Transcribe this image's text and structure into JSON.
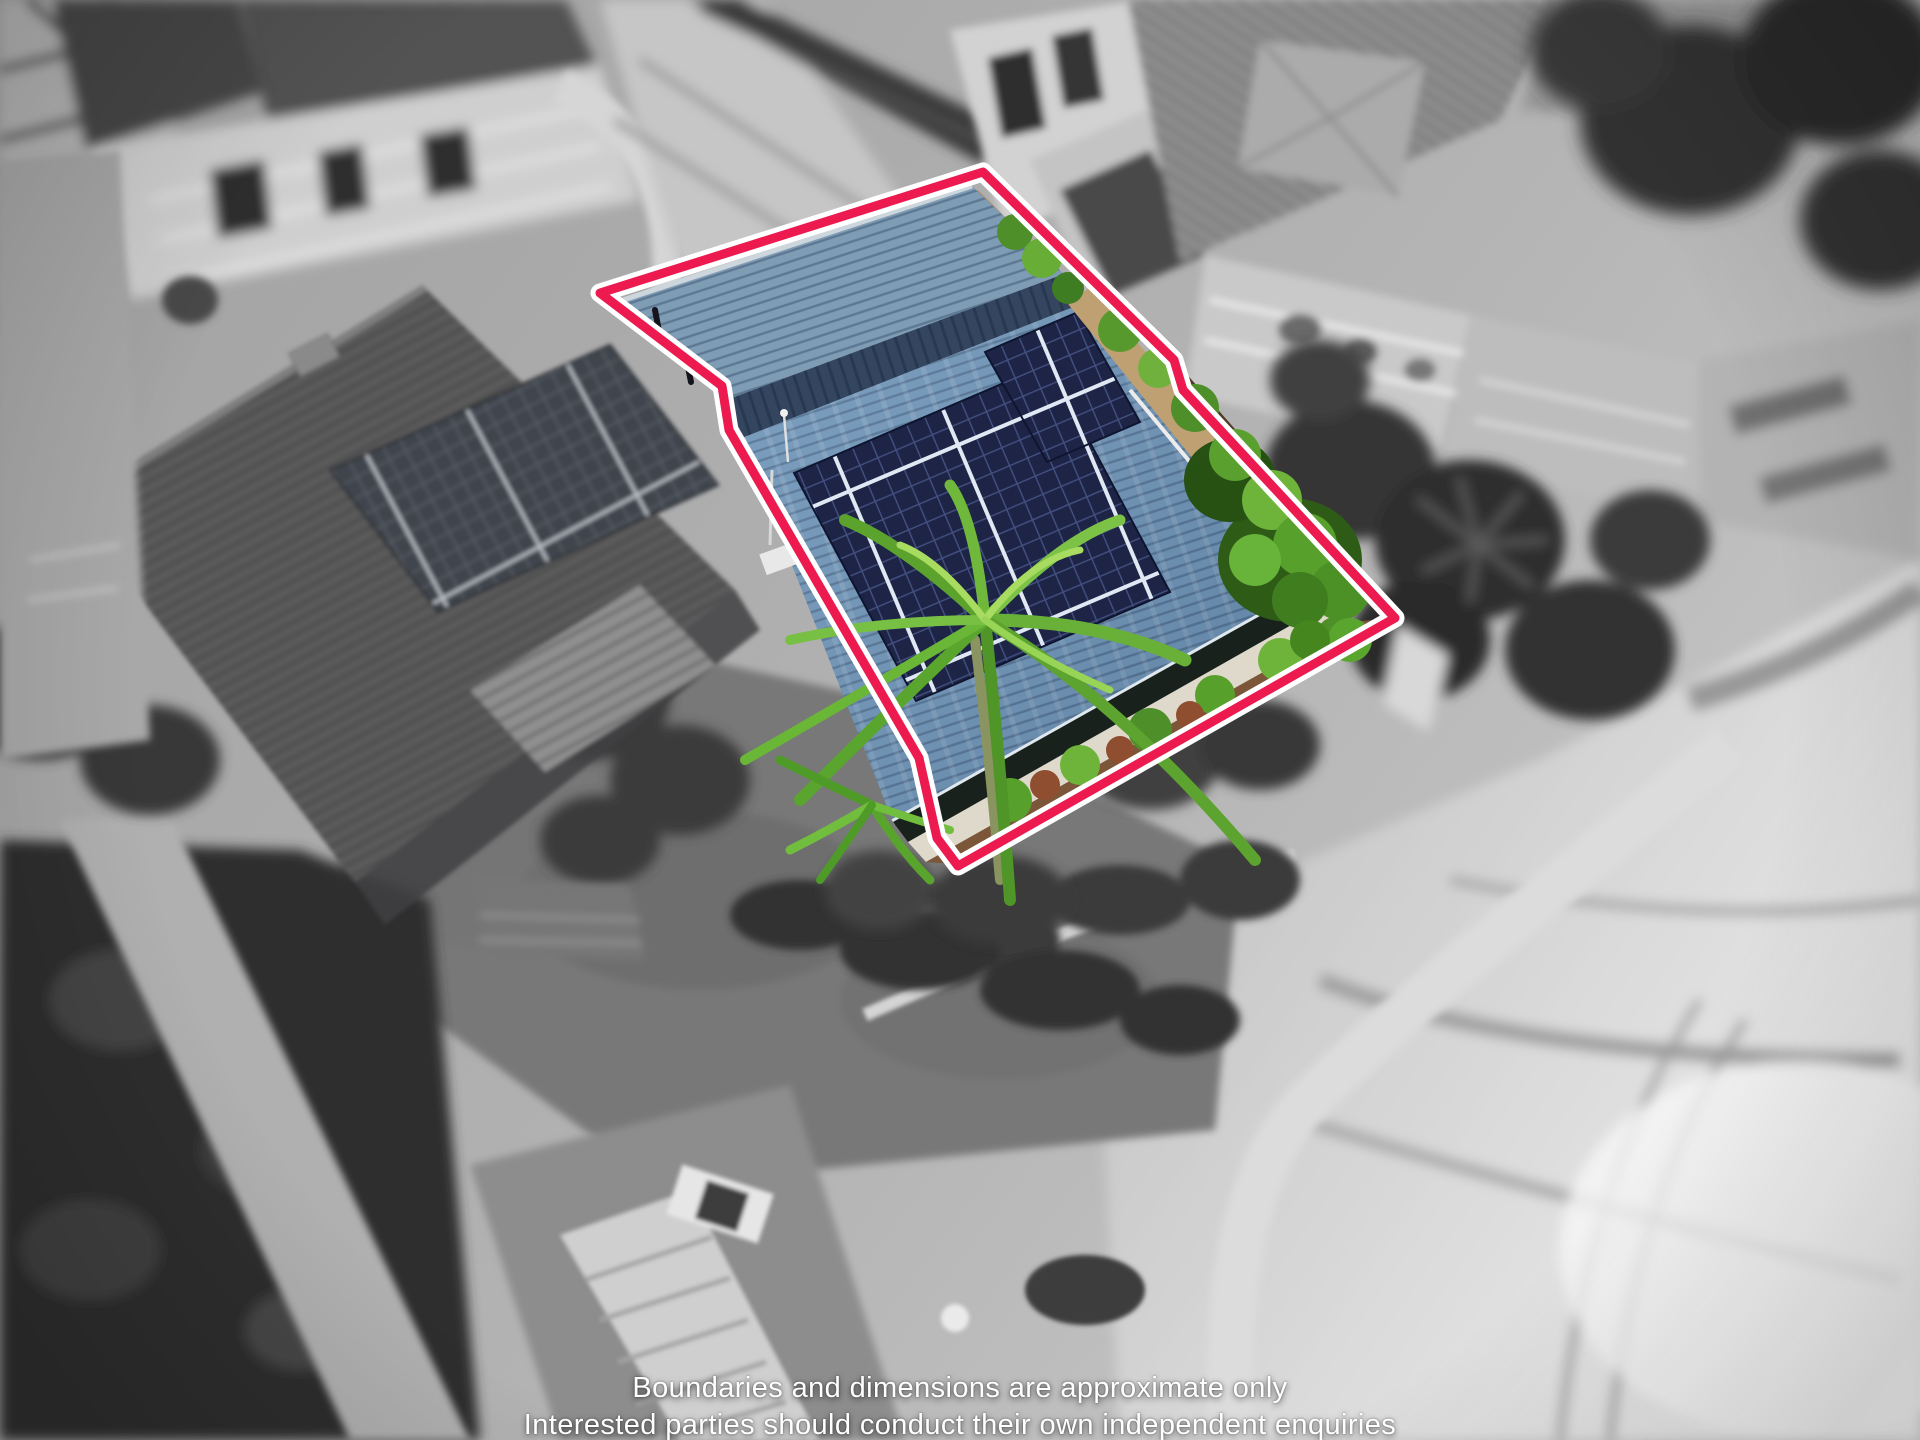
{
  "photo": {
    "kind": "aerial-drone-property-photo",
    "style": "selective colour: highlighted property in colour over desaturated surroundings",
    "subject": "single-storey beachfront house with blue tiled roof, rooftop solar array and palm tree"
  },
  "boundary": {
    "label": "property boundary outline",
    "points": "600,293 983,172 1174,360 1183,390 1395,618 958,866 937,838 919,758 729,430 722,386",
    "stroke_color": "#ec1a4e",
    "casing_color": "#ffffff",
    "stroke_width": 9,
    "casing_width": 19
  },
  "palette": {
    "roof_main": "#6d94b8",
    "roof_back": "#7f9cb5",
    "roof_ridge": "#33455f",
    "solar_panel": "#1d2446",
    "palm_green": "#6ab33a",
    "shrub_green": "#57a02c",
    "garden_soil": "#7b5639",
    "side_path_tan": "#bfa072",
    "sand_light": "#f1f1f1",
    "mono_dark": "#2f2f2f",
    "mono_light": "#d6d6d6"
  },
  "disclaimer": {
    "line1": "Boundaries and dimensions are approximate only",
    "line2": "Interested parties should conduct their own independent enquiries"
  }
}
